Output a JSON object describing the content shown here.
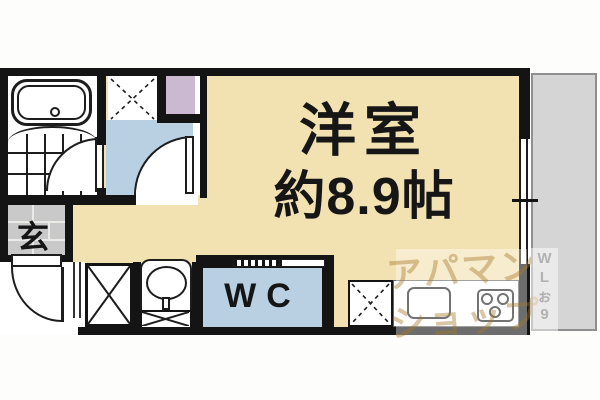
{
  "labels": {
    "room_line1": "洋室",
    "room_line2": "約8.9帖",
    "genkan": "玄",
    "wc": "WC"
  },
  "watermark": {
    "line1": "アパマン",
    "line2": "ショップ",
    "side_letters": [
      "W",
      "L",
      "ぉ",
      "9"
    ]
  },
  "colors": {
    "floor": "#f2e2b1",
    "wet": "#b9d0e2",
    "pipe": "#cbb9d2",
    "genkan": "#c9c9c9",
    "balcony": "#d5d5d5",
    "wall": "#141414",
    "line": "#1d1d1d",
    "watermark": "rgba(164,120,40,0.42)",
    "watermark_side": "rgba(122,122,122,0.5)"
  },
  "fixtures": [
    "bathtub",
    "bathroom-tile-floor",
    "washing-machine-space",
    "pipe-space",
    "washroom",
    "bathroom-door",
    "washroom-door",
    "genkan",
    "entrance-door",
    "closet",
    "washbasin",
    "toilet-room",
    "sliding-door",
    "refrigerator-space",
    "kitchen-counter",
    "kitchen-sink",
    "gas-stove",
    "window",
    "balcony"
  ]
}
